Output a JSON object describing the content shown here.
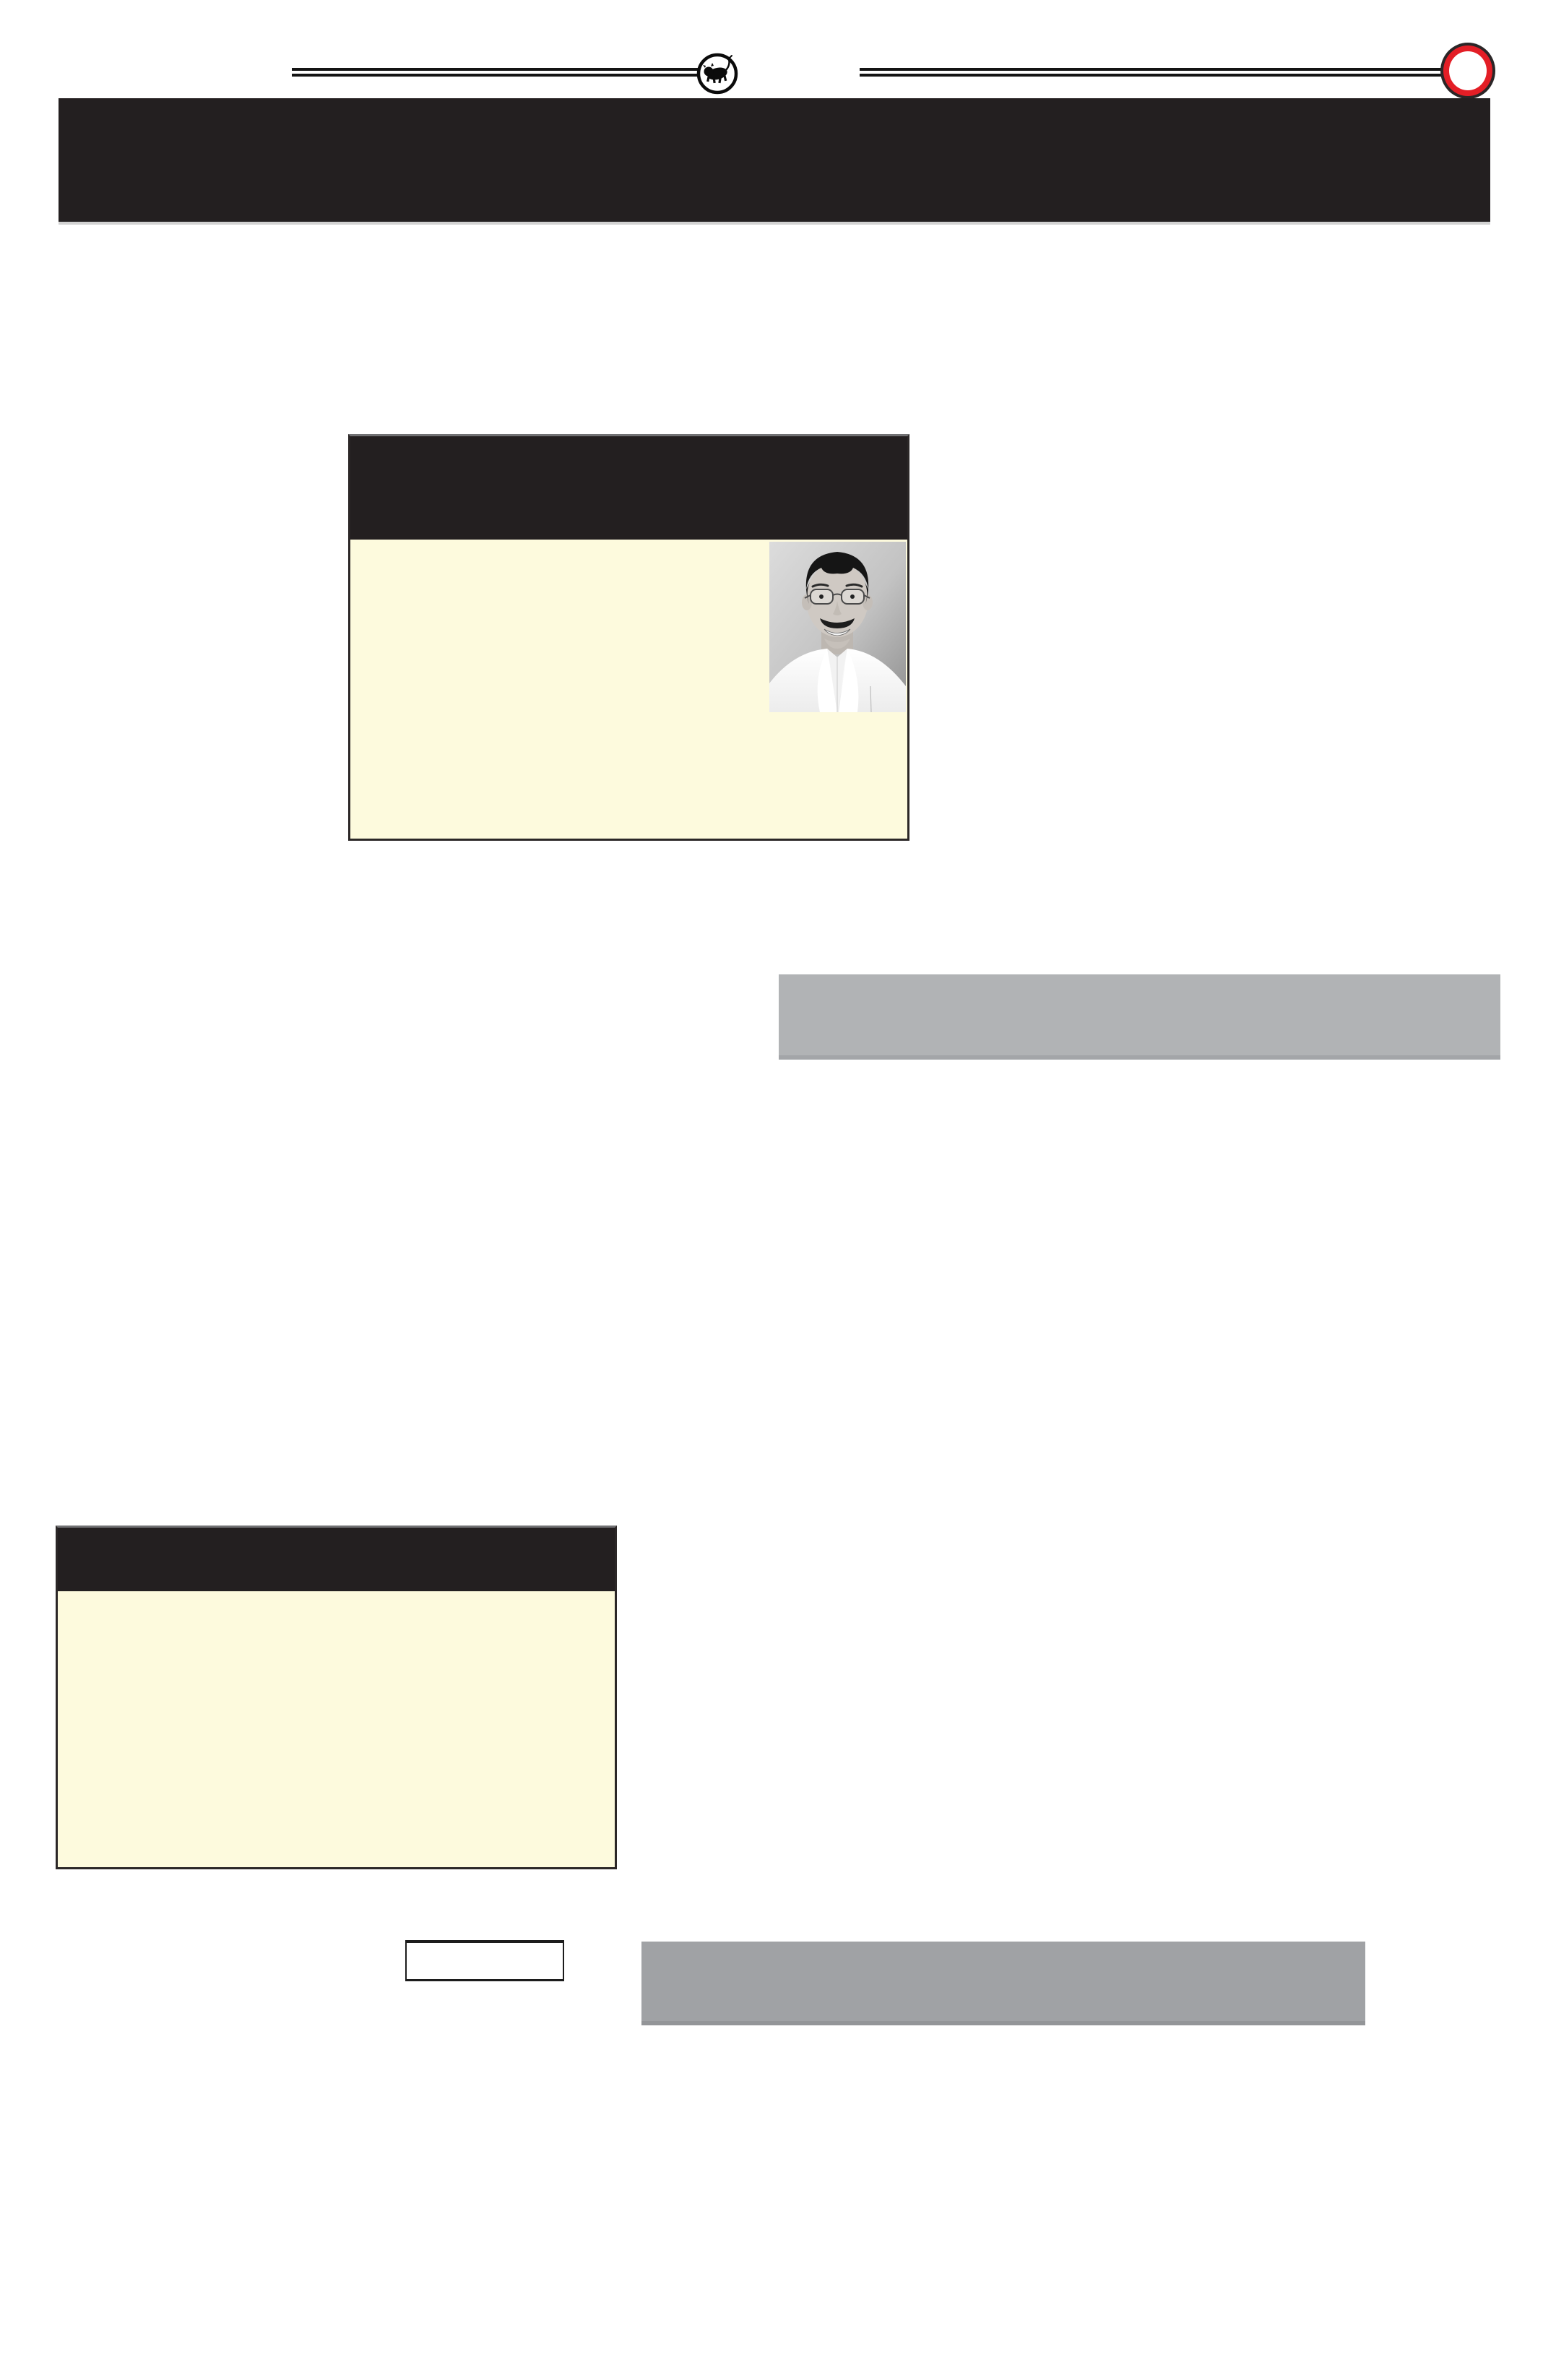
{
  "page": {
    "background": "#ffffff"
  },
  "colors": {
    "page_bg": "#ffffff",
    "banner_dark": "#231f20",
    "banner_shadow": "#d2d2d2",
    "rule_black": "#141414",
    "ring_red": "#e31e26",
    "ring_outline": "#2b2627",
    "box_border": "#2b2727",
    "box_border_top": "#717173",
    "panel_cream": "#fdfadd",
    "strip_gray_1": "#b1b3b5",
    "strip_gray_1_edge": "#a3a5a8",
    "strip_gray_2": "#a0a2a5",
    "strip_gray_2_edge": "#939598",
    "small_box_border": "#1c1c1c"
  },
  "masthead": {
    "emblem_icon": "bull-emblem-icon",
    "ring_icon": "red-ring-icon"
  },
  "photo": {
    "description": "black-and-white portrait of a smiling man with glasses, mustache and white shirt"
  }
}
